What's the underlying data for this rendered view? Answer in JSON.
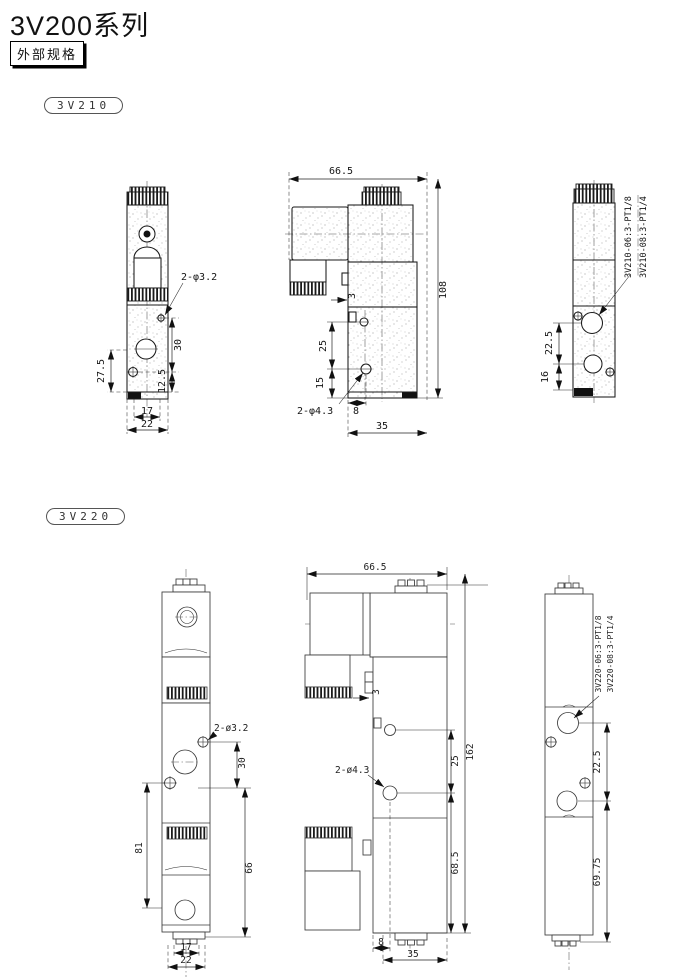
{
  "page": {
    "title": "3V200系列",
    "section_label": "外部规格"
  },
  "colors": {
    "ink": "#1a1a1a",
    "paper": "#ffffff"
  },
  "v210": {
    "badge": "3V210",
    "front": {
      "hole_label": "2-φ3.2",
      "dim_30": "30",
      "dim_12_5": "12.5",
      "dim_27_5": "27.5",
      "dim_17": "17",
      "dim_22": "22"
    },
    "side": {
      "dim_66_5": "66.5",
      "dim_108": "108",
      "dim_3": "3",
      "dim_25": "25",
      "dim_15": "15",
      "hole_label": "2-φ4.3",
      "dim_8": "8",
      "dim_35": "35"
    },
    "back": {
      "port_label_1": "3V210-06:3-PT1/8",
      "port_label_2": "3V210-08:3-PT1/4",
      "dim_22_5": "22.5",
      "dim_16": "16"
    }
  },
  "v220": {
    "badge": "3V220",
    "front": {
      "hole_label": "2-ø3.2",
      "dim_30": "30",
      "dim_81": "81",
      "dim_66": "66",
      "dim_17": "17",
      "dim_22": "22"
    },
    "side": {
      "dim_66_5": "66.5",
      "dim_3": "3",
      "dim_162": "162",
      "dim_25": "25",
      "hole_label": "2-ø4.3",
      "dim_68_5": "68.5",
      "dim_8": "8",
      "dim_35": "35"
    },
    "back": {
      "port_label_1": "3V220-06:3-PT1/8",
      "port_label_2": "3V220-08:3-PT1/4",
      "dim_22_5": "22.5",
      "dim_69_75": "69.75"
    }
  }
}
